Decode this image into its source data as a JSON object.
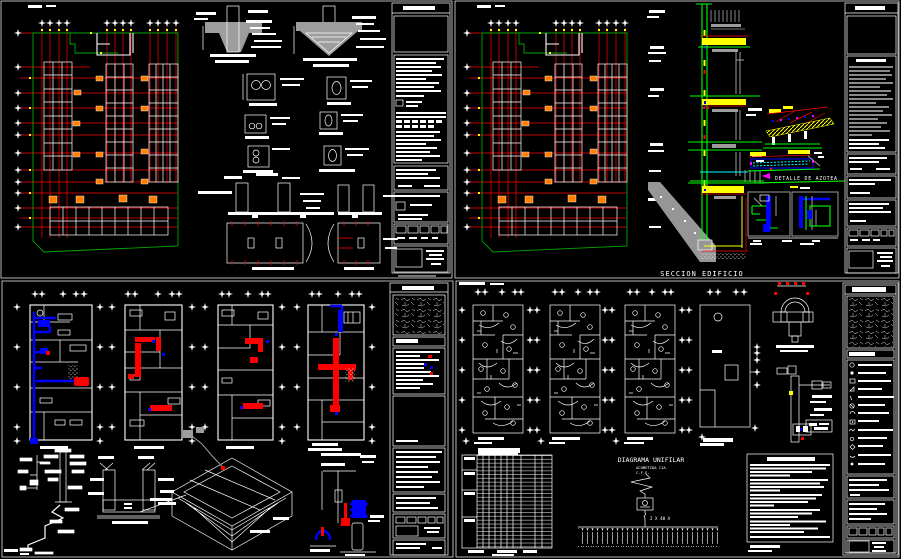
{
  "palette": {
    "background": "#000000",
    "line_white": "#ffffff",
    "axis_red": "#ff0000",
    "boundary_green": "#00a800",
    "bright_green": "#00ff00",
    "yellow": "#ffff00",
    "column_orange": "#ff7f00",
    "blue": "#0000ff",
    "cyan": "#00ffff",
    "magenta": "#ff00ff",
    "gray": "#9d9d9d"
  },
  "sheets": {
    "top_right": {
      "section_label": "SECCION EDIFICIO",
      "roof_detail_label": "DETALLE DE AZOTEA"
    },
    "bottom_right": {
      "unifilar_title": "DIAGRAMA UNIFILAR",
      "acometida_line1": "ACOMETIDA CIA.",
      "acometida_line2": "C.F.E.",
      "main_breaker_rating": "2 X 40 A"
    }
  }
}
